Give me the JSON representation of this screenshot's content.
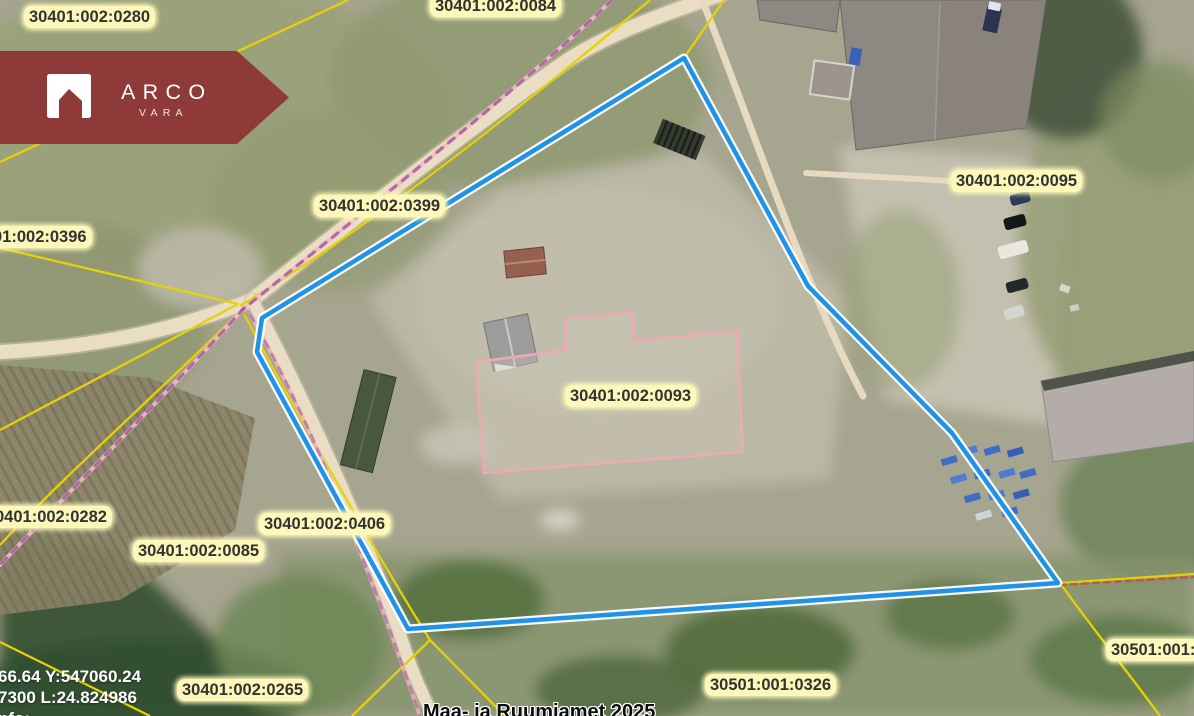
{
  "brand": {
    "name": "ARCO",
    "subname": "VARA"
  },
  "colors": {
    "brand": "#8d3a38",
    "boundary_blue": "#1f93e8",
    "cadastral_yellow": "#e5d104",
    "centerline_pink": "#f3bac6",
    "centerline_purple": "#a65ba0",
    "ruin_outline_pink": "#f0a8b6",
    "label_bg": "#fdf8ba"
  },
  "map": {
    "selected_parcel": "30401:002:0093",
    "parcel_labels": [
      {
        "label": "30401:002:0280"
      },
      {
        "label": "30401:002:0084"
      },
      {
        "label": "30401:002:0399"
      },
      {
        "label": "01:002:0396"
      },
      {
        "label": "30401:002:0095"
      },
      {
        "label": "30401:002:0093"
      },
      {
        "label": "0401:002:0282"
      },
      {
        "label": "30401:002:0085"
      },
      {
        "label": "30401:002:0406"
      },
      {
        "label": "30501:001:"
      },
      {
        "label": "30501:001:0326"
      },
      {
        "label": "30401:002:0265"
      }
    ]
  },
  "status": {
    "line1": "66.64 Y:547060.24",
    "line2": "7300 L:24.824986",
    "line3": "nfo:"
  },
  "attribution": "Maa- ja Ruumiamet 2025"
}
